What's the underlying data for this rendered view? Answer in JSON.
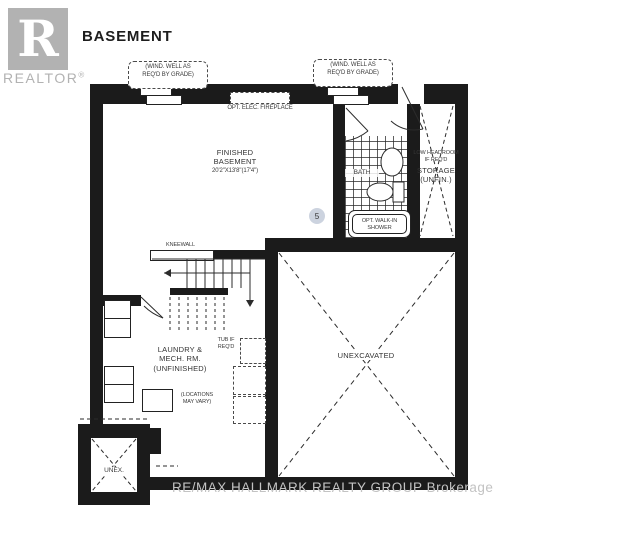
{
  "header": {
    "title": "BASEMENT"
  },
  "logo": {
    "letter": "R",
    "realtor": "REALTOR",
    "reg": "®"
  },
  "watermark": {
    "text": "RE/MAX HALLMARK REALTY GROUP Brokerage"
  },
  "colors": {
    "wall": "#1b1b1b",
    "logo_gray": "#b2b2b2",
    "watermark_gray": "#c3c3c3",
    "keynote_circle": "#ccd3df",
    "line": "#2b2b2b"
  },
  "labels": {
    "window_well": {
      "l1": "(WIND. WELL AS",
      "l2": "REQ'D BY GRADE)"
    },
    "fireplace": "OPT. ELEC. FIREPLACE",
    "kneewall": "KNEEWALL",
    "marker5": "5",
    "shower": {
      "l1": "OPT. WALK-IN",
      "l2": "SHOWER"
    },
    "tub": {
      "l1": "TUB IF",
      "l2": "REQ'D"
    },
    "locations": {
      "l1": "(LOCATIONS",
      "l2": "MAY VARY)"
    }
  },
  "rooms": {
    "finished": {
      "l1": "FINISHED",
      "l2": "BASEMENT",
      "dims": "20'2\"X13'8\"(17'4\")"
    },
    "bath": {
      "name": "BATH"
    },
    "storage": {
      "l1": "LOW HEADROOM",
      "l2": "IF REQ'D",
      "l3": "STORAGE",
      "l4": "(UNFIN.)"
    },
    "laundry": {
      "l1": "LAUNDRY &",
      "l2": "MECH. RM.",
      "l3": "(UNFINISHED)"
    },
    "unexcavated": {
      "name": "UNEXCAVATED"
    },
    "unex": {
      "name": "UNEX."
    }
  }
}
